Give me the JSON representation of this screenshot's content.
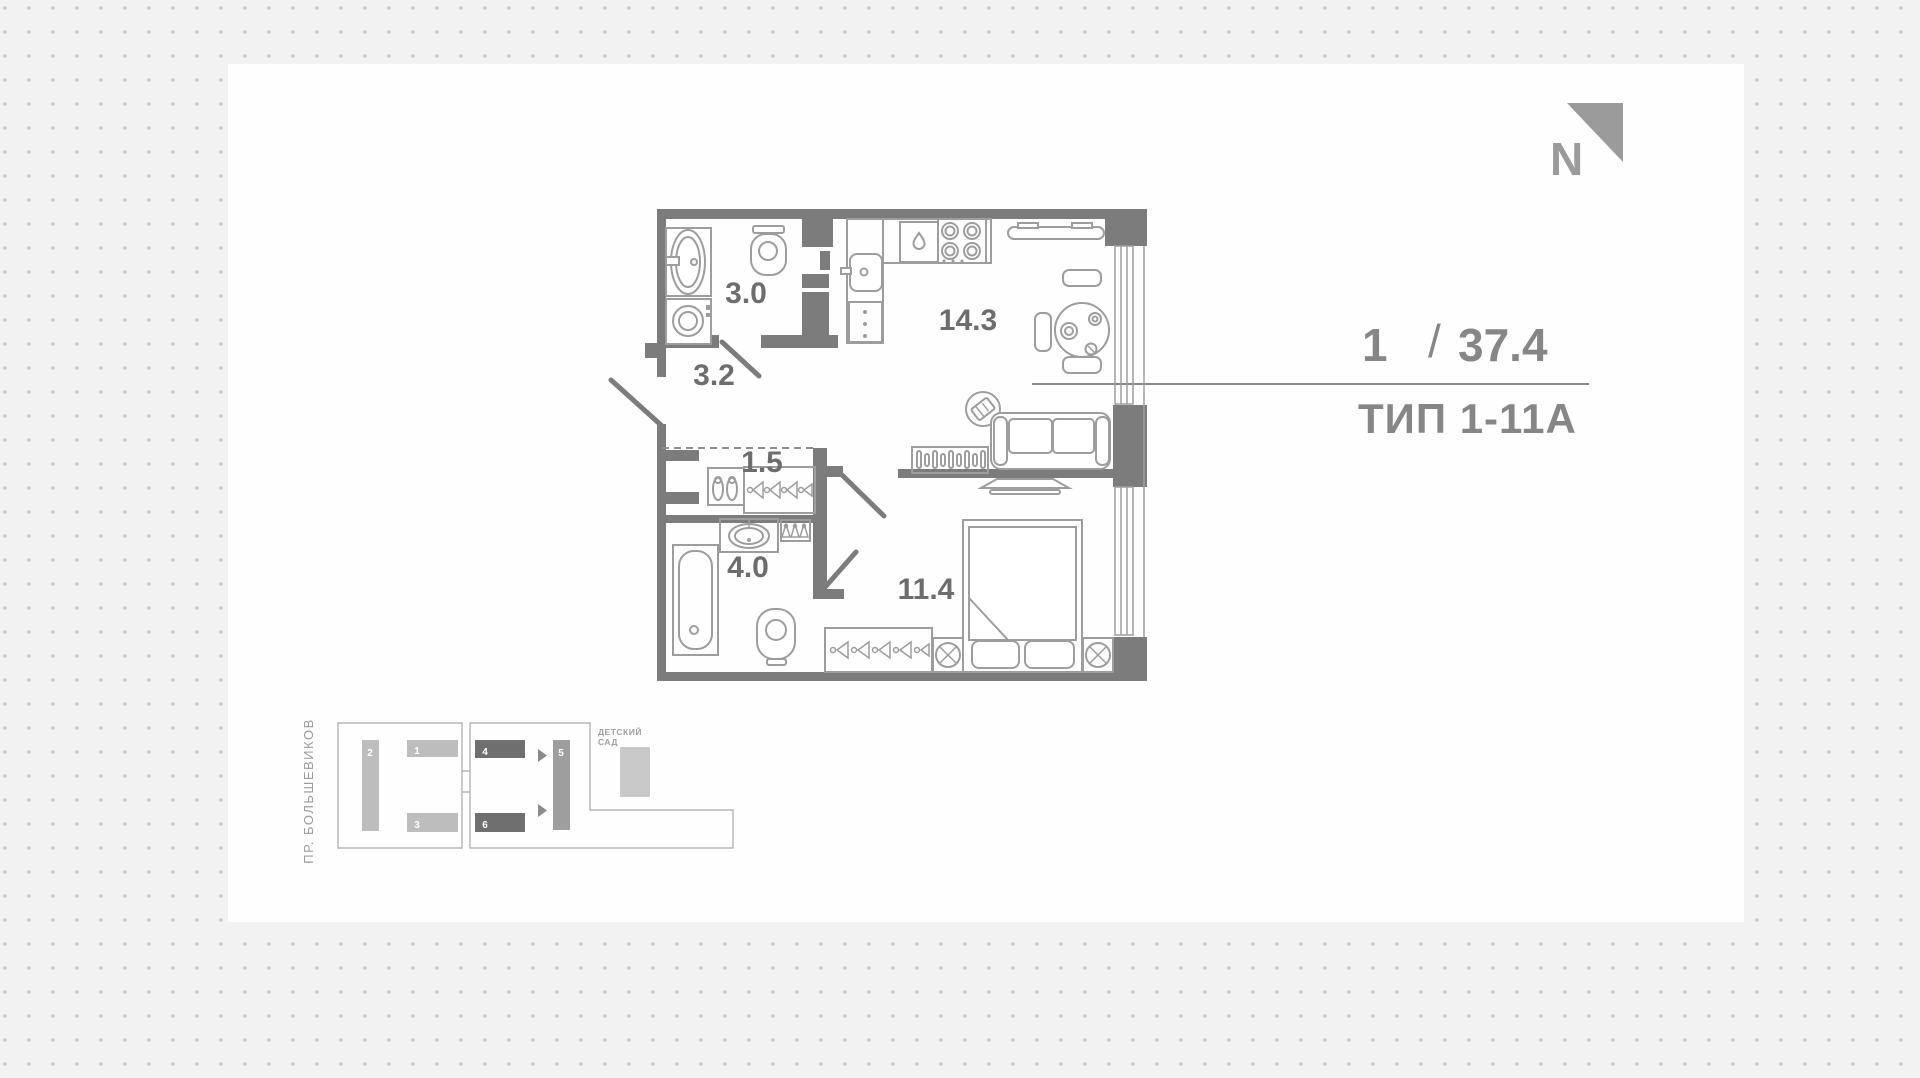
{
  "north_indicator": {
    "label": "N"
  },
  "title_block": {
    "rooms": "1",
    "divider": "/",
    "area": "37.4",
    "type": "ТИП 1-11А"
  },
  "floor_plan": {
    "room_areas": {
      "bathroom_small": "3.0",
      "hallway": "3.2",
      "closet": "1.5",
      "bathroom": "4.0",
      "kitchen_living": "14.3",
      "bedroom": "11.4"
    }
  },
  "site_map": {
    "street": "ПР. БОЛЬШЕВИКОВ",
    "kindergarten_line1": "ДЕТСКИЙ",
    "kindergarten_line2": "САД",
    "buildings": [
      {
        "number": "1"
      },
      {
        "number": "2"
      },
      {
        "number": "3"
      },
      {
        "number": "4"
      },
      {
        "number": "5"
      },
      {
        "number": "6"
      }
    ]
  },
  "colors": {
    "wall": "#7c7c7c",
    "furniture": "#9d9d9d",
    "room_label": "#6d6d6d",
    "title_text": "#868686",
    "highlight_building": "#6f6f6f",
    "regular_building": "#bdbdbd",
    "panel_background": "#fefefe",
    "page_background": "#f2f2f2"
  }
}
